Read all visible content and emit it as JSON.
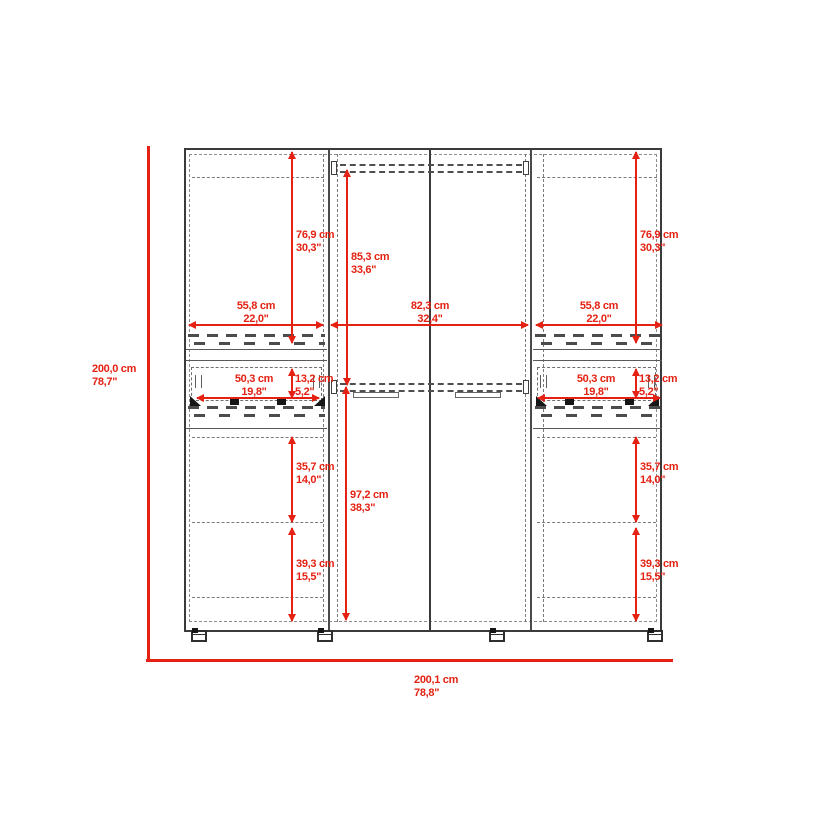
{
  "diagram": {
    "subject": "wardrobe-front-dimension-drawing"
  },
  "colors": {
    "dimension_red": "#e42112",
    "line_dark": "#3b3b3b",
    "line_dashed": "#7a7a7a",
    "background": "#ffffff"
  },
  "dims": {
    "overall_height": {
      "cm": "200,0 cm",
      "in": "78,7\""
    },
    "overall_width": {
      "cm": "200,1 cm",
      "in": "78,8\""
    },
    "side_door_height": {
      "cm": "76,9 cm",
      "in": "30,3\""
    },
    "center_upper_height": {
      "cm": "85,3 cm",
      "in": "33,6\""
    },
    "center_lower_height": {
      "cm": "97,2 cm",
      "in": "38,3\""
    },
    "side_section_width": {
      "cm": "55,8 cm",
      "in": "22,0\""
    },
    "center_section_width": {
      "cm": "82,3 cm",
      "in": "32,4\""
    },
    "drawer_width": {
      "cm": "50,3 cm",
      "in": "19,8\""
    },
    "drawer_height": {
      "cm": "13,2 cm",
      "in": "5,2\""
    },
    "lower_upper_shelf_height": {
      "cm": "35,7 cm",
      "in": "14,0\""
    },
    "lower_bottom_shelf_height": {
      "cm": "39,3 cm",
      "in": "15,5\""
    }
  }
}
